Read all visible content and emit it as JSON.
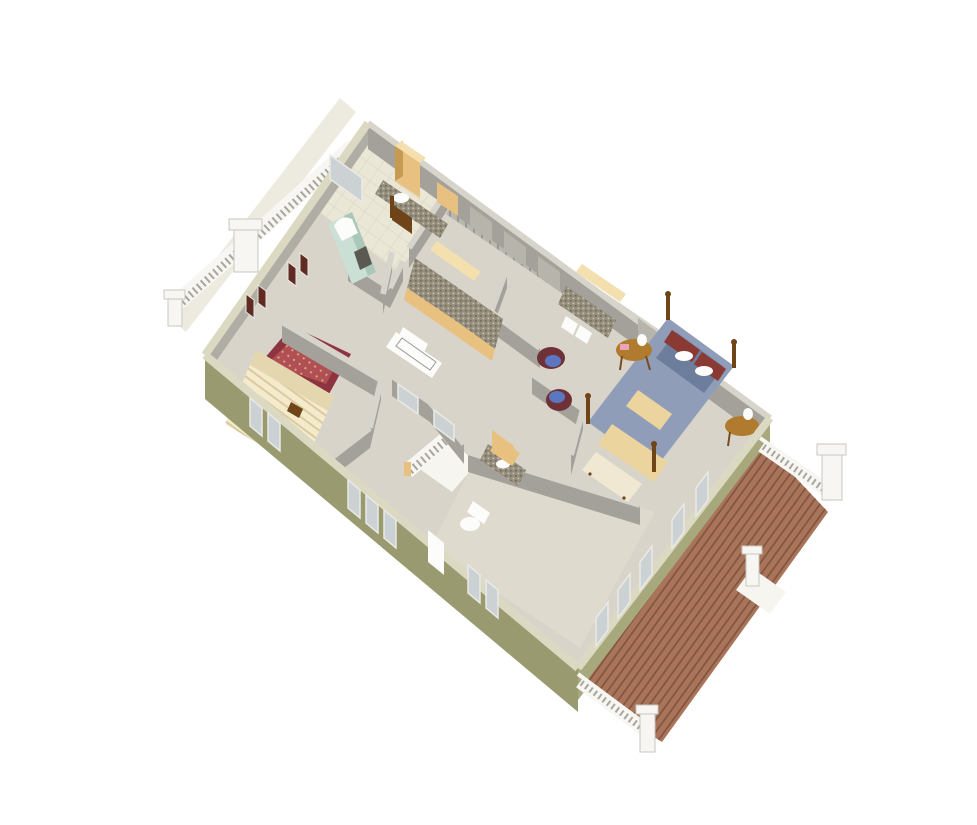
{
  "meta": {
    "description": "3D dollhouse-style overhead rendering of a single floor plan on a white background, rotated diagonally",
    "view": "isometric overhead, long axis running lower-left to upper-right"
  },
  "palette": {
    "bg": "#ffffff",
    "floor": "#d8d4c9",
    "floorTile": "#ebe7d7",
    "floorBottom": "#dedacd",
    "floorWhite": "#f6f5f0",
    "balconyFloor": "#edebe0",
    "wallFace": "#a4a19a",
    "wallFaceLight": "#b0ada5",
    "wallCap": "#d7d4cb",
    "wallGroove": "#b6b4ab",
    "extOlive": "#9a9a71",
    "extOliveLight": "#a8a87d",
    "extCap": "#dcd9c3",
    "closet": "#b9b7af",
    "closetGroove": "#8f8d85",
    "deckWood": "#a97459",
    "deckPlank": "#7d5340",
    "railWhite": "#f7f6f2",
    "railTick": "#a8a69d",
    "railShadow": "#c9c7c0",
    "rugBorder": "#8e3440",
    "rugField": "#b14f57",
    "rugAccent": "#d9a868",
    "bedCream": "#f4ebcd",
    "bedStripe": "#dbc9a0",
    "woodDark": "#6f4418",
    "woodMid": "#b07b2e",
    "cabinetTan": "#e8c180",
    "cabinetTanDark": "#c79a52",
    "cabinetTanLight": "#f4dfae",
    "granite": "#958d7b",
    "graniteDark": "#6f6a5e",
    "graniteLight": "#c9c2ae",
    "white": "#fcfcfa",
    "mint": "#cbe0d5",
    "mintDark": "#a9c8ba",
    "beddingBlue": "#8f9db8",
    "beddingBlueDark": "#6d7d9c",
    "pillowMaroon": "#8a3a32",
    "blanketTan": "#ecd49e",
    "chairMaroon": "#6e3138",
    "chairBlue": "#5c77c2",
    "shutterMaroon": "#5f2b23",
    "glass": "#ccd2d4",
    "windowFrame": "#e9e9e5",
    "artDark": "#45413a",
    "pink": "#eba4b8",
    "outlineGray": "#9a988f"
  },
  "scene": {
    "rooms": [
      {
        "id": "hall-bathroom",
        "contents": [
          "tile floor",
          "granite vanity with sink",
          "tall tan cabinet",
          "wood chair",
          "window"
        ]
      },
      {
        "id": "front-bedroom",
        "contents": [
          "cream striped bed",
          "red oriental rug",
          "maroon shuttered windows"
        ]
      },
      {
        "id": "kitchenette",
        "contents": [
          "U-shaped tan cabinets with granite top",
          "white appliance"
        ]
      },
      {
        "id": "stair-hall",
        "contents": [
          "staircase with white railing",
          "bay nook with windows"
        ]
      },
      {
        "id": "lower-bathroom",
        "contents": [
          "granite vanity with sink",
          "toilet",
          "bathtub"
        ]
      },
      {
        "id": "laundry-nook",
        "contents": [
          "tan cabinets with granite top",
          "washer and dryer"
        ]
      },
      {
        "id": "sitting-area",
        "contents": [
          "two maroon chairs with blue cushions"
        ]
      },
      {
        "id": "master-bedroom",
        "contents": [
          "four-poster bed with blue bedding",
          "foot bench",
          "two round nightstands with lamps",
          "framed wall art",
          "closet wall"
        ]
      },
      {
        "id": "bonus-room",
        "contents": [
          "empty floor",
          "glazed doors to deck"
        ]
      },
      {
        "id": "rear-deck",
        "contents": [
          "diagonal wood planking",
          "white railings",
          "corner posts",
          "stair landing"
        ]
      },
      {
        "id": "front-balcony",
        "contents": [
          "white railing",
          "square posts",
          "chimney cap"
        ]
      },
      {
        "id": "fireplace",
        "contents": [
          "mint green chimney block with white arched surround"
        ]
      }
    ]
  }
}
